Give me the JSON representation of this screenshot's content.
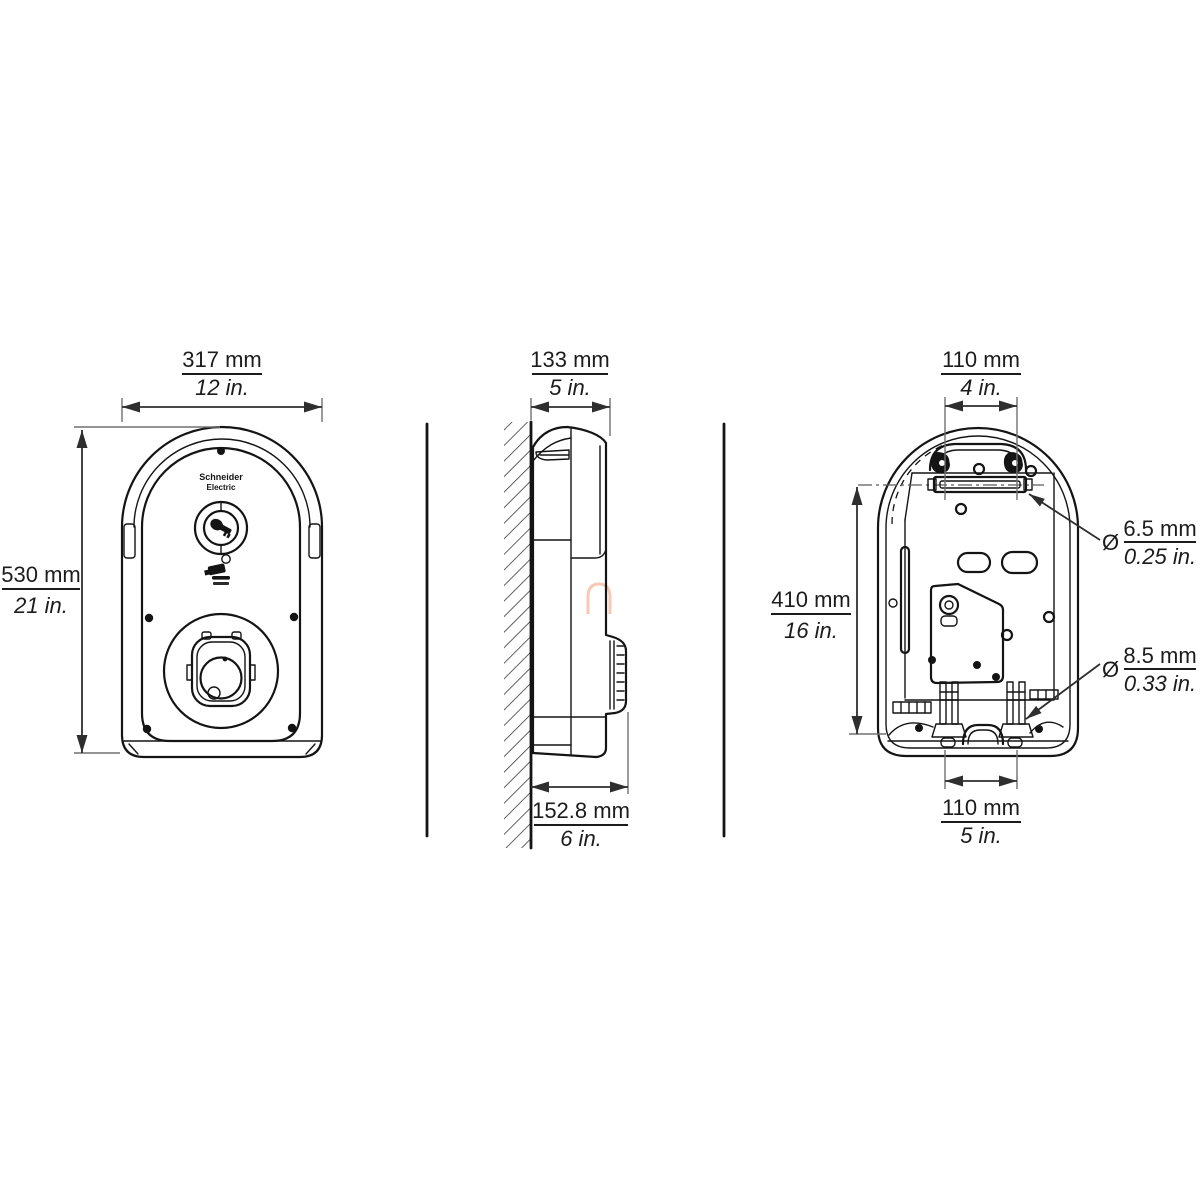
{
  "colors": {
    "background": "#ffffff",
    "artwork_line": "#141414",
    "dimension_line": "#2e2e2e",
    "extension_line": "#707070",
    "text": "#1c1c1c",
    "watermark": "#f6c9b6"
  },
  "branding": {
    "logo_line1": "Schneider",
    "logo_line2": "Electric"
  },
  "icons": {
    "key_switch": "key-switch-icon",
    "ev_charging": "ev-charging-icon",
    "charging_socket": "charging-socket",
    "wall_hatch": "wall-section-hatch"
  },
  "dimensions": {
    "front_width": {
      "metric": "317 mm",
      "imperial": "12 in."
    },
    "front_height": {
      "metric": "530 mm",
      "imperial": "21 in."
    },
    "side_depth_top": {
      "metric": "133 mm",
      "imperial": "5 in."
    },
    "side_depth_bottom": {
      "metric": "152.8 mm",
      "imperial": "6 in."
    },
    "rear_top_spacing": {
      "metric": "110 mm",
      "imperial": "4 in."
    },
    "rear_height": {
      "metric": "410 mm",
      "imperial": "16 in."
    },
    "rear_top_hole": {
      "symbol": "Ø",
      "metric": "6.5 mm",
      "imperial": "0.25 in."
    },
    "rear_bottom_hole": {
      "symbol": "Ø",
      "metric": "8.5 mm",
      "imperial": "0.33 in."
    },
    "rear_bottom_spacing": {
      "metric": "110 mm",
      "imperial": "5 in."
    }
  }
}
